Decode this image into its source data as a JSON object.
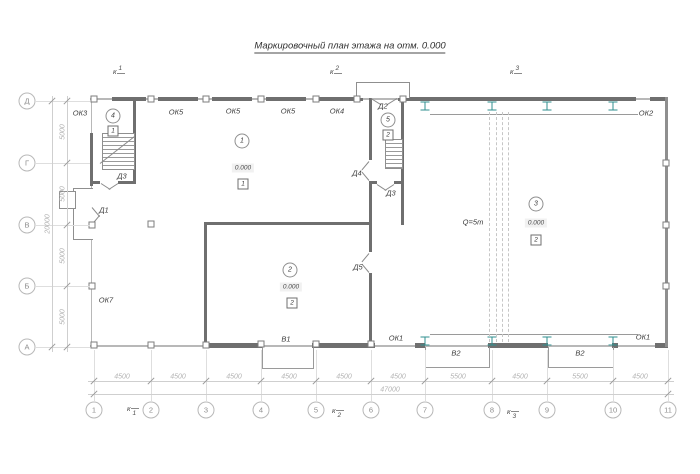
{
  "title": "Маркировочный план этажа на отм. 0.000",
  "sections": {
    "letter": "к",
    "s1": "1",
    "s2": "2",
    "s3": "3"
  },
  "axes": {
    "bottom": [
      "1",
      "2",
      "3",
      "4",
      "5",
      "6",
      "7",
      "8",
      "9",
      "10",
      "11"
    ],
    "left": [
      "Д",
      "Г",
      "В",
      "Б",
      "А"
    ]
  },
  "dims": {
    "bottom": [
      "4500",
      "4500",
      "4500",
      "4500",
      "4500",
      "4500",
      "5500",
      "4500",
      "5500",
      "4500"
    ],
    "total_bottom": "47000",
    "left": [
      "5000",
      "5000",
      "5000",
      "5000"
    ],
    "total_left": "20000"
  },
  "openings": {
    "ok1": "ОК1",
    "ok2": "ОК2",
    "ok3": "ОК3",
    "ok4": "ОК4",
    "ok5": "ОК5",
    "ok7": "ОК7",
    "d1": "Д1",
    "d2": "Д2",
    "d3": "Д3",
    "d4": "Д4",
    "d5": "Д5",
    "v1": "В1",
    "v2": "В2"
  },
  "rooms": {
    "r1": {
      "num": "1",
      "elev": "0.000",
      "type": "1"
    },
    "r2": {
      "num": "2",
      "elev": "0.000",
      "type": "2"
    },
    "r3": {
      "num": "3",
      "elev": "0.000",
      "type": "2"
    },
    "r4": {
      "num": "4",
      "type": "1"
    },
    "r5": {
      "num": "5",
      "type": "2"
    }
  },
  "crane": {
    "capacity": "Q=5т"
  }
}
